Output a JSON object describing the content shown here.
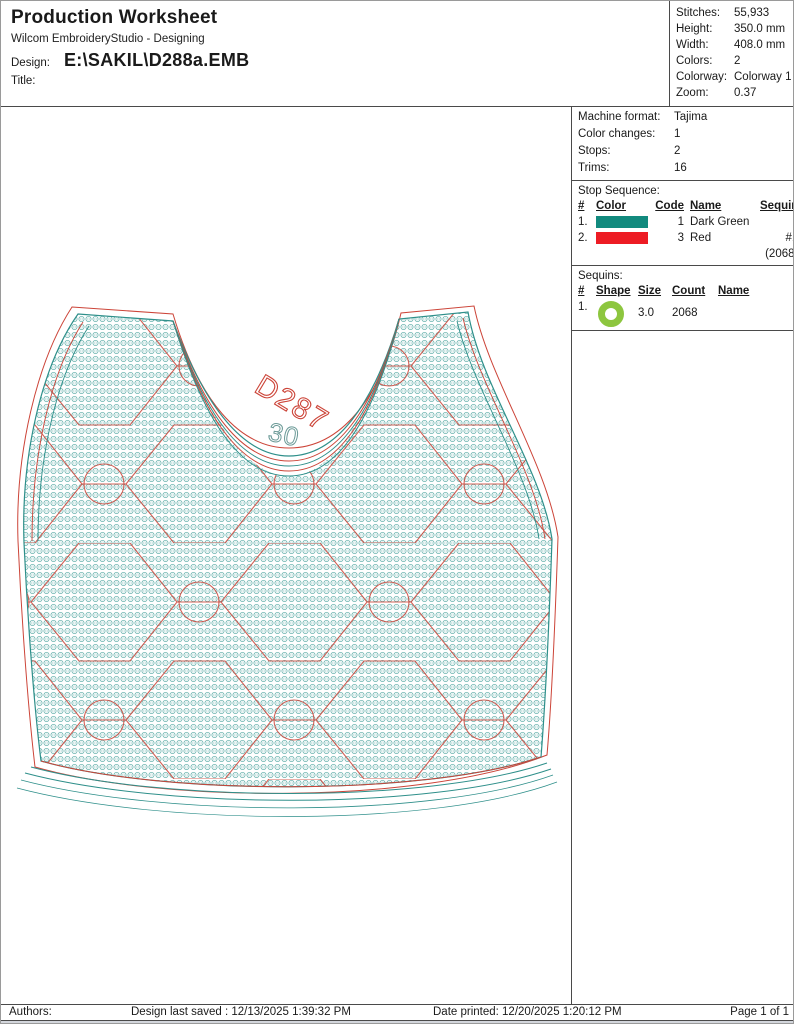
{
  "header": {
    "title": "Production Worksheet",
    "subtitle": "Wilcom EmbroideryStudio - Designing",
    "design_label": "Design:",
    "design_value": "E:\\SAKIL\\D288a.EMB",
    "title_label": "Title:",
    "title_value": ""
  },
  "stats": {
    "rows": [
      {
        "label": "Stitches:",
        "value": "55,933"
      },
      {
        "label": "Height:",
        "value": "350.0 mm"
      },
      {
        "label": "Width:",
        "value": "408.0 mm"
      },
      {
        "label": "Colors:",
        "value": "2"
      },
      {
        "label": "Colorway:",
        "value": "Colorway 1"
      },
      {
        "label": "Zoom:",
        "value": "0.37"
      }
    ]
  },
  "machine": {
    "rows": [
      {
        "label": "Machine format:",
        "value": "Tajima"
      },
      {
        "label": "Color changes:",
        "value": "1"
      },
      {
        "label": "Stops:",
        "value": "2"
      },
      {
        "label": "Trims:",
        "value": "16"
      }
    ]
  },
  "stop_sequence": {
    "heading": "Stop Sequence:",
    "columns": {
      "num": "#",
      "color": "Color",
      "code": "Code",
      "name": "Name",
      "sequin": "Sequin"
    },
    "rows": [
      {
        "num": "1.",
        "swatch_color": "#128a7e",
        "code": "1",
        "name": "Dark Green",
        "sequin": ""
      },
      {
        "num": "2.",
        "swatch_color": "#ed1c24",
        "code": "3",
        "name": "Red",
        "sequin": "#1 (2068)"
      }
    ]
  },
  "sequins": {
    "heading": "Sequins:",
    "columns": {
      "num": "#",
      "shape": "Shape",
      "size": "Size",
      "count": "Count",
      "name": "Name"
    },
    "rows": [
      {
        "num": "1.",
        "shape_icon": "green-ring",
        "ring_color": "#8dc63f",
        "size": "3.0",
        "count": "2068",
        "name": ""
      }
    ]
  },
  "design": {
    "code_label": "D287",
    "size_label": "30",
    "colors": {
      "teal": "#2e8f8a",
      "red": "#cc4438",
      "texture_teal": "#3a9a94"
    }
  },
  "footer": {
    "authors_label": "Authors:",
    "saved": "Design last saved : 12/13/2025 1:39:32 PM",
    "printed": "Date printed: 12/20/2025 1:20:12 PM",
    "page": "Page 1 of 1"
  }
}
